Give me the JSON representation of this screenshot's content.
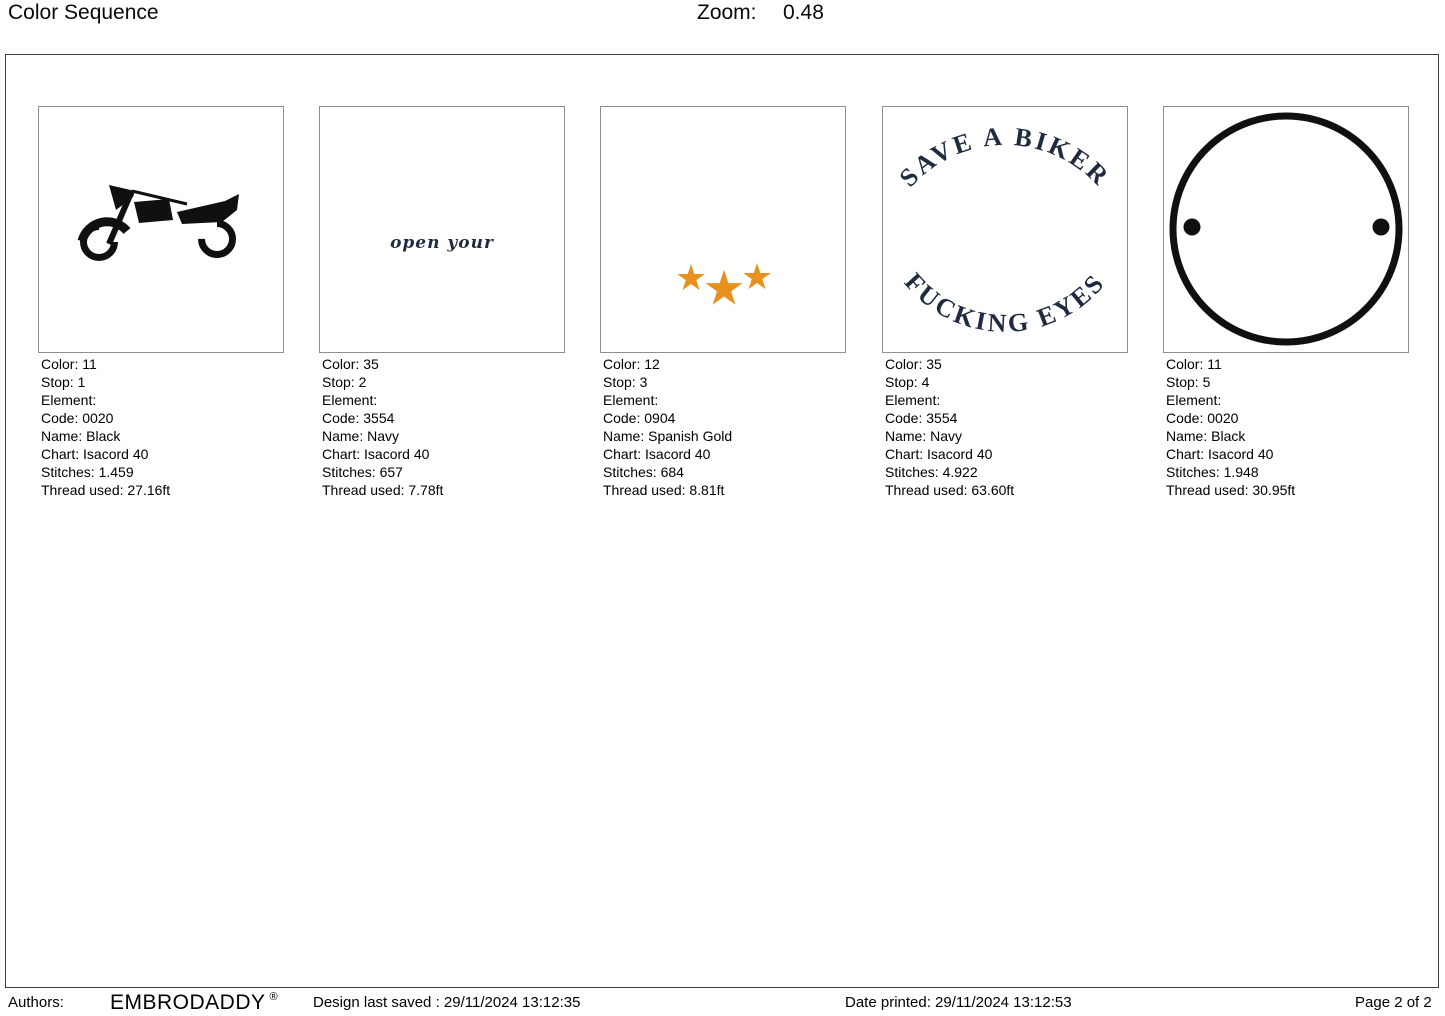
{
  "header": {
    "title": "Color Sequence",
    "zoom_label": "Zoom:",
    "zoom_value": "0.48"
  },
  "palette": {
    "navy": "#1e2b40",
    "spanish_gold": "#e8911f",
    "black": "#101010"
  },
  "stops": [
    {
      "design": "motorcycle-silhouette",
      "lines": [
        "Color: 11",
        "Stop: 1",
        "Element:",
        "Code: 0020",
        "Name: Black",
        "Chart: Isacord 40",
        "Stitches: 1.459",
        "Thread used: 27.16ft"
      ]
    },
    {
      "design": "script-text",
      "design_text": "open your",
      "lines": [
        "Color: 35",
        "Stop: 2",
        "Element:",
        "Code: 3554",
        "Name: Navy",
        "Chart: Isacord 40",
        "Stitches: 657",
        "Thread used: 7.78ft"
      ]
    },
    {
      "design": "three-stars",
      "star_char": "★",
      "lines": [
        "Color: 12",
        "Stop: 3",
        "Element:",
        "Code: 0904",
        "Name: Spanish Gold",
        "Chart: Isacord 40",
        "Stitches: 684",
        "Thread used: 8.81ft"
      ]
    },
    {
      "design": "arc-text",
      "text_top": "SAVE A BIKER",
      "text_bottom": "FUCKING EYES",
      "lines": [
        "Color: 35",
        "Stop: 4",
        "Element:",
        "Code: 3554",
        "Name: Navy",
        "Chart: Isacord 40",
        "Stitches: 4.922",
        "Thread used: 63.60ft"
      ]
    },
    {
      "design": "circle-outline",
      "lines": [
        "Color: 11",
        "Stop: 5",
        "Element:",
        "Code: 0020",
        "Name: Black",
        "Chart: Isacord 40",
        "Stitches: 1.948",
        "Thread used: 30.95ft"
      ]
    }
  ],
  "footer": {
    "authors_label": "Authors:",
    "brand": "EMBRODADDY",
    "registered_mark": "®",
    "last_saved": "Design last saved : 29/11/2024 13:12:35",
    "date_printed": "Date printed: 29/11/2024 13:12:53",
    "page": "Page 2 of 2"
  }
}
